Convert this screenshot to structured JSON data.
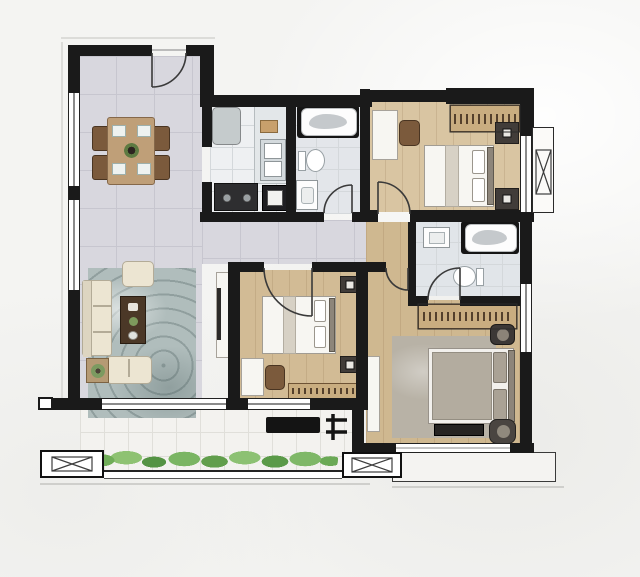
{
  "canvas": {
    "width": 640,
    "height": 577,
    "description": "rendered apartment floor plan, 3-bedroom 2-bath unit with balcony, no text labels"
  },
  "palette": {
    "background": "#f4f4f2",
    "wall": "#1a1a1a",
    "windowFill": "#ffffff",
    "tileMain": "#d8d7de",
    "kitchenFloor": "#eef0f2",
    "bath1Floor": "#e3e6ea",
    "bath2Floor": "#e1e5e9",
    "woodBedroom2": "#d9c5a2",
    "woodBedroom3": "#d2bb95",
    "woodMaster": "#cfb890",
    "balconyFloor": "#f3f2ef",
    "bayFloor": "#f4f3f1",
    "livingRug": "#b0bdbc",
    "masterRug": "#b8b2a6",
    "sofaCream": "#ece5d2",
    "diningWood": "#bf9f78",
    "coffeeTable": "#4b3827",
    "wardrobe": "#c9ad80",
    "hangerStroke": "#54402c",
    "nightstand": "#413c39",
    "stove": "#2e2e30",
    "counter": "#e3e7e9",
    "fridge": "#c5cbcc",
    "duvetGray": "#b3ac9f",
    "bedWhite": "#f7f6f2",
    "plantGreen": "#6fae57",
    "benchBlack": "#141414"
  },
  "rooms": [
    {
      "name": "dining-area",
      "floor": "tile",
      "furniture": [
        "dining-table",
        "dining-chair-x4",
        "place-setting-x4",
        "centerpiece"
      ]
    },
    {
      "name": "kitchen",
      "floor": "hard-tile",
      "furniture": [
        "fridge",
        "counter",
        "microwave",
        "double-sink",
        "cooktop",
        "base-cabinet"
      ]
    },
    {
      "name": "bathroom-1",
      "floor": "hard-tile",
      "furniture": [
        "bathtub",
        "toilet",
        "vanity-sink"
      ]
    },
    {
      "name": "bedroom-2",
      "floor": "wood",
      "furniture": [
        "wardrobe",
        "desk",
        "desk-chair",
        "double-bed",
        "bedside-unit-x2"
      ]
    },
    {
      "name": "hallway",
      "floor": "tile",
      "furniture": []
    },
    {
      "name": "bathroom-2-ensuite",
      "floor": "hard-tile",
      "furniture": [
        "vanity-sink",
        "bathtub",
        "toilet"
      ]
    },
    {
      "name": "bedroom-3",
      "floor": "wood",
      "furniture": [
        "double-bed",
        "bedside-unit-x2",
        "desk",
        "desk-chair",
        "wardrobe"
      ]
    },
    {
      "name": "living-room",
      "floor": "tile",
      "furniture": [
        "sofa",
        "armchair",
        "loveseat",
        "coffee-table",
        "side-table-with-plant",
        "tv-cabinet"
      ]
    },
    {
      "name": "master-bedroom",
      "floor": "wood",
      "furniture": [
        "wardrobe",
        "tv-cabinet",
        "area-rug",
        "double-bed",
        "nightstand",
        "tv-console",
        "round-chair"
      ]
    },
    {
      "name": "balcony",
      "floor": "white-tile",
      "furniture": [
        "planter-greenery",
        "weight-bench",
        "barbell-rack"
      ]
    },
    {
      "name": "bay-window-bedroom-2",
      "furniture": []
    },
    {
      "name": "bay-window-master",
      "furniture": []
    }
  ],
  "doors": [
    "entry-door",
    "bathroom-1-door",
    "bedroom-2-door",
    "bedroom-3-door",
    "master-bedroom-door",
    "bathroom-2-door",
    "kitchen-opening"
  ],
  "structure": [
    "column-box-left",
    "column-box-right",
    "balcony-railing",
    "bay-mullion-x"
  ]
}
